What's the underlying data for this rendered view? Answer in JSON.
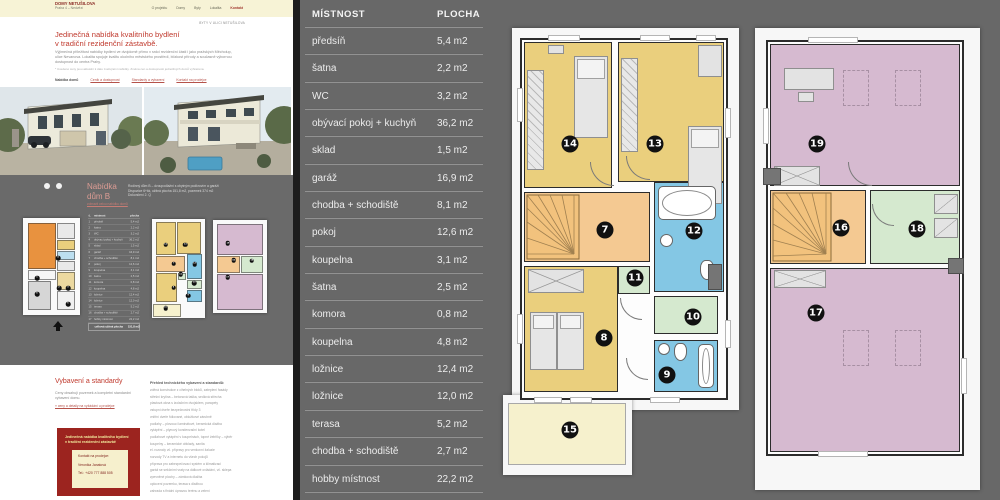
{
  "website": {
    "logo_line1": "DOMY NETUŠILOVA",
    "logo_line2": "Praha 4 – Nedvězí",
    "nav": [
      "O projektu",
      "Domy",
      "Byty",
      "Lokalita",
      "Kontakt"
    ],
    "breadcrumb": "BYTY V ULICI NETUŠILOVA",
    "hero_title_line1": "Jedinečná nabídka kvalitního bydlení",
    "hero_title_line2": "v tradiční rezidenční zástavbě.",
    "hero_paragraph": "Výjimečná příležitost nabídky bydlení ve dvojdomě přímo v srdci rezidenční části i jako pražských Měcholup, ulice Nevanova. Lokalita spojuje kvalitu okolního městského prostředí, blízkost přírody a současně výbornou dostupnost do centra Prahy.",
    "hero_footnote": "* Uvedené ceny jsou aktuální k datu zveřejnění nabídky. Změna cen a dostupnosti jednotlivých domů vyhrazena.",
    "hero_links": [
      "Nabídka domů",
      "Ceník a dostupnost",
      "Standardy a vybavení",
      "Kontakt na prodejce"
    ],
    "offer": {
      "title_line1": "Nabídka",
      "title_line2": "dům B",
      "subtitle_link": "zobrazit celou nabídku domů",
      "address_lines": [
        "Rodinný dům B – dvoupodlažní s obytným podkrovím a garáží",
        "Dispozice 6+kk, užitná plocha 151,8 m2, pozemek 374 m2",
        "Dokončení 2. Q"
      ]
    },
    "standards": {
      "title": "Vybavení a standardy",
      "paragraph": "Ceny obsahují pozemek a kompletní standardní vybavení domu.",
      "link": "» ceny a detaily na vyžádání u prodejce",
      "promo_line1": "Jedinečná nabídka kvalitního bydlení",
      "promo_line2": "v tradiční rezidenční zástavbě",
      "contact_label": "Kontakt na prodejce:",
      "contact_name": "Veronika Janatová",
      "contact_phone": "Tel.: +420 777 888 505",
      "features_heading": "Přehled technického vybavení a standardů:",
      "features": [
        "zděná konstrukce z cihelných bloků, zateplení fasády",
        "střešní krytina – betonová taška, sedlová střecha",
        "plastová okna s izolačním dvojsklem, parapety",
        "vstupní dveře bezpečnostní třídy 3",
        "vnitřní dveře fóliované, obložkové zárubně",
        "podlahy – plovoucí laminátové, keramická dlažba",
        "vytápění – plynový kondenzační kotel",
        "podlahové vytápění v koupelnách, topné žebříky – výběr",
        "koupelny – keramické obklady, sanita",
        "el. rozvody vč. přípravy pro venkovní žaluzie",
        "rozvody TV a internetu do všech pokojů",
        "příprava pro zabezpečovací systém a klimatizaci",
        "garáž se sekčními vraty na dálkové ovládání, vč. sklepa",
        "zpevněné plochy – zámková dlažba",
        "oplocení pozemku, terasa s dlažbou",
        "zahrada s finální úpravou terénu a zelení"
      ]
    }
  },
  "room_table": {
    "headers": [
      "MÍSTNOST",
      "PLOCHA"
    ],
    "mini_headers": [
      "č.",
      "místnost",
      "plocha"
    ],
    "rows": [
      {
        "name": "předsíň",
        "area": "5,4 m2"
      },
      {
        "name": "šatna",
        "area": "2,2 m2"
      },
      {
        "name": "WC",
        "area": "3,2 m2"
      },
      {
        "name": "obývací pokoj + kuchyň",
        "area": "36,2 m2"
      },
      {
        "name": "sklad",
        "area": "1,5 m2"
      },
      {
        "name": "garáž",
        "area": "16,9 m2"
      },
      {
        "name": "chodba + schodiště",
        "area": "8,1 m2"
      },
      {
        "name": "pokoj",
        "area": "12,6 m2"
      },
      {
        "name": "koupelna",
        "area": "3,1 m2"
      },
      {
        "name": "šatna",
        "area": "2,5 m2"
      },
      {
        "name": "komora",
        "area": "0,8 m2"
      },
      {
        "name": "koupelna",
        "area": "4,8 m2"
      },
      {
        "name": "ložnice",
        "area": "12,4 m2"
      },
      {
        "name": "ložnice",
        "area": "12,0 m2"
      },
      {
        "name": "terasa",
        "area": "5,2 m2"
      },
      {
        "name": "chodba + schodiště",
        "area": "2,7 m2"
      },
      {
        "name": "hobby místnost",
        "area": "22,2 m2"
      }
    ],
    "mini_total_label": "celková užitná plocha",
    "mini_total_value": "151,8 m2"
  },
  "floorplans": {
    "first_floor_badges": [
      {
        "n": "14",
        "x": 70,
        "y": 116
      },
      {
        "n": "13",
        "x": 155,
        "y": 116
      },
      {
        "n": "7",
        "x": 105,
        "y": 202
      },
      {
        "n": "12",
        "x": 194,
        "y": 203
      },
      {
        "n": "11",
        "x": 135,
        "y": 250
      },
      {
        "n": "8",
        "x": 104,
        "y": 310
      },
      {
        "n": "10",
        "x": 193,
        "y": 289
      },
      {
        "n": "9",
        "x": 167,
        "y": 347
      },
      {
        "n": "15",
        "x": 70,
        "y": 402
      }
    ],
    "attic_badges": [
      {
        "n": "19",
        "x": 69,
        "y": 116
      },
      {
        "n": "16",
        "x": 93,
        "y": 200
      },
      {
        "n": "18",
        "x": 169,
        "y": 201
      },
      {
        "n": "17",
        "x": 68,
        "y": 285
      }
    ],
    "ground_badges": [
      {
        "n": "4",
        "x": 35,
        "y": 40
      },
      {
        "n": "1",
        "x": 14,
        "y": 60
      },
      {
        "n": "6",
        "x": 14,
        "y": 76
      },
      {
        "n": "2",
        "x": 36,
        "y": 70
      },
      {
        "n": "3",
        "x": 45,
        "y": 70
      },
      {
        "n": "5",
        "x": 45,
        "y": 86
      }
    ]
  },
  "colors": {
    "accent_red": "#c03a2e",
    "header_cream": "#f7f3d6",
    "panel_gray": "#686868",
    "promo_red": "#9c241f",
    "room_yellow": "#eacf7d",
    "room_orange": "#f4c992",
    "room_blue": "#84c7e4",
    "room_green": "#d5e9cf",
    "room_purple": "#d6bad0",
    "terrace_cream": "#f6f1cd",
    "badge_black": "#111111"
  }
}
